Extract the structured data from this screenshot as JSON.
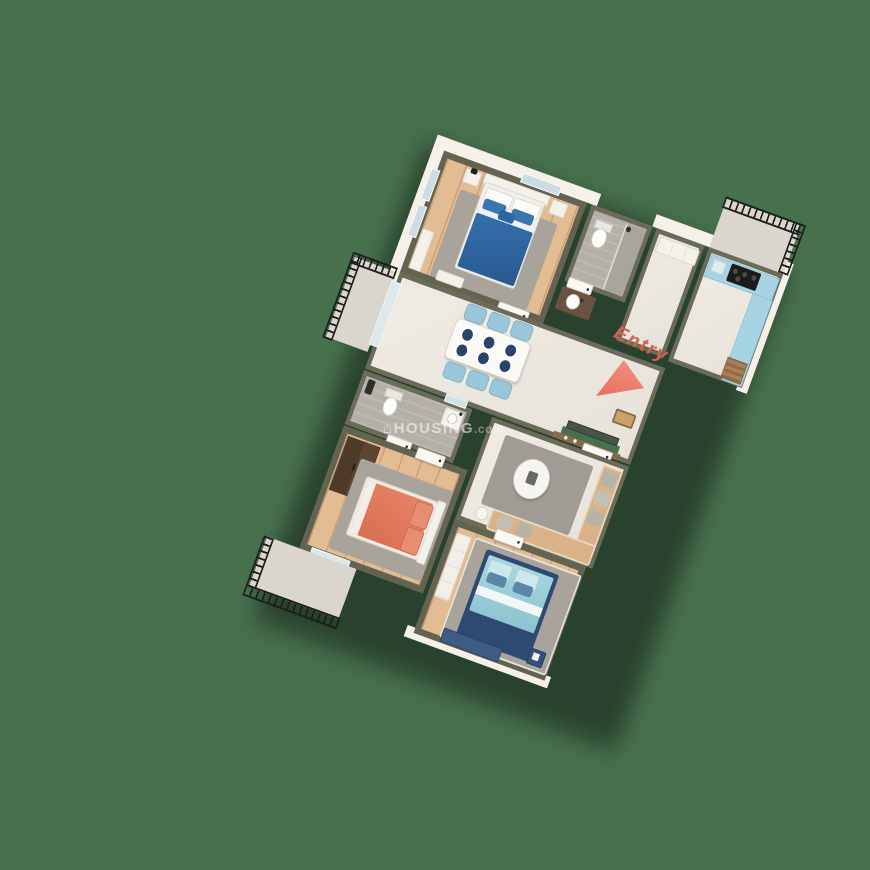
{
  "scene": {
    "type": "3D isometric apartment floor plan render",
    "background_color": "#47704d"
  },
  "watermark": {
    "house_icon": "⌂",
    "brand": "HOUSING",
    "tld": ".com"
  },
  "entry": {
    "label": "Entry",
    "arrow_color": "#e96f5e"
  },
  "colors": {
    "wall_top": "#626350",
    "wall_face": "#f6f1e8",
    "wood_floor": "#e2bd94",
    "marble_floor": "#ebe7df",
    "tile_floor": "#b4b0a8",
    "rug": "#a8a49c",
    "master_bed": "#2c66a2",
    "coral_bed": "#df7a5e",
    "light_blue_bed": "#9fd0da",
    "navy_frame": "#2e4a73",
    "kitchen_counter": "#a7d4e4",
    "dining_chair": "#99c7d9",
    "sofa": "#d9b288",
    "brown_wardrobe": "#59422f",
    "railing": "#1d1d1d"
  },
  "rooms": [
    {
      "name": "master-bedroom",
      "items": [
        "double-bed-blue",
        "nightstand",
        "nightstand",
        "gray-rug",
        "bench",
        "window",
        "window",
        "window",
        "door"
      ]
    },
    {
      "name": "master-bathroom",
      "items": [
        "toilet",
        "shower",
        "glass-partition",
        "washbasin-vanity",
        "door"
      ]
    },
    {
      "name": "foyer-dressing",
      "items": [
        "white-wardrobe"
      ]
    },
    {
      "name": "kitchen",
      "items": [
        "l-shaped-counter",
        "gas-hob",
        "sink",
        "storage-crate"
      ]
    },
    {
      "name": "kitchen-balcony",
      "items": [
        "black-railing"
      ]
    },
    {
      "name": "dining-hall",
      "items": [
        "dining-table",
        "6-chairs",
        "6-plates",
        "tv-niche",
        "tv-console",
        "doormat"
      ]
    },
    {
      "name": "sit-out-balcony",
      "items": [
        "black-railing",
        "sliding-glass-door"
      ]
    },
    {
      "name": "common-bathroom",
      "items": [
        "toilet",
        "shower-set",
        "washbasin",
        "mirror",
        "door"
      ]
    },
    {
      "name": "bedroom-2",
      "items": [
        "double-bed-coral",
        "brown-wardrobe",
        "gray-rug",
        "sliding-glass-door",
        "door"
      ]
    },
    {
      "name": "bedroom-2-balcony",
      "items": [
        "black-railing"
      ]
    },
    {
      "name": "living-room",
      "items": [
        "l-shaped-sofa",
        "gray-pillows",
        "round-coffee-table",
        "gray-rug",
        "side-stool",
        "door"
      ]
    },
    {
      "name": "bedroom-3",
      "items": [
        "double-bed-light-blue",
        "navy-bench",
        "navy-nightstand",
        "white-wardrobe",
        "gray-rug",
        "door"
      ]
    }
  ]
}
